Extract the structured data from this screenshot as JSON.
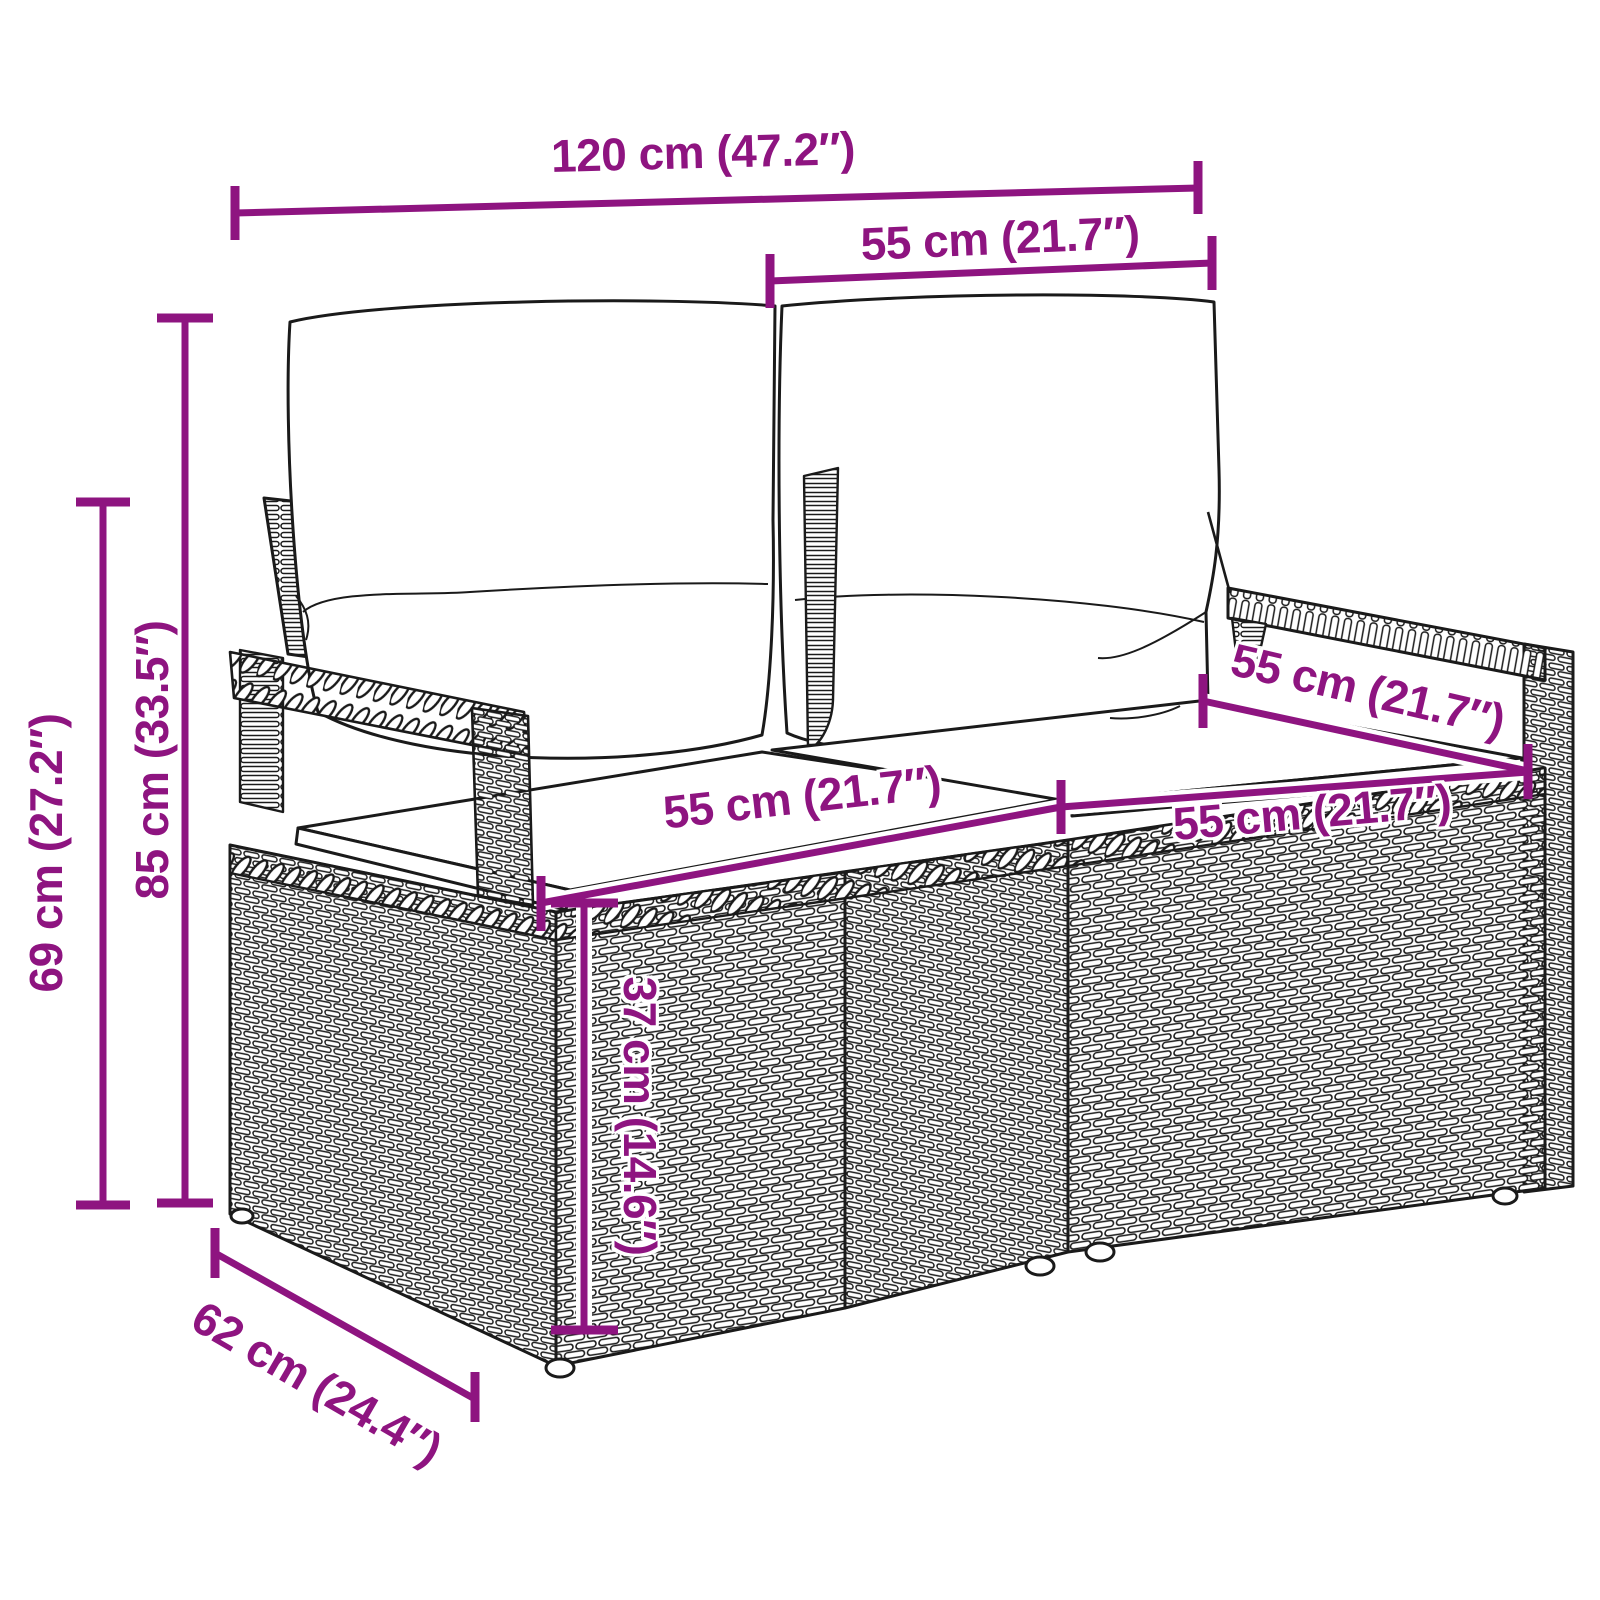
{
  "colors": {
    "accent": "#8E1480",
    "line_art": "#1a1a1a",
    "background": "#ffffff"
  },
  "product": {
    "description": "rattan-garden-bench-with-cushions-dimension-diagram"
  },
  "dimensions": {
    "overall_width": "120 cm (47.2″)",
    "back_cushion_width": "55 cm (21.7″)",
    "overall_height": "85 cm (33.5″)",
    "arm_height": "69 cm (27.2″)",
    "seat_width_left": "55 cm (21.7″)",
    "seat_width_right": "55 cm (21.7″)",
    "seat_depth": "55 cm (21.7″)",
    "seat_height": "37 cm (14.6″)",
    "overall_depth": "62 cm (24.4″)"
  }
}
